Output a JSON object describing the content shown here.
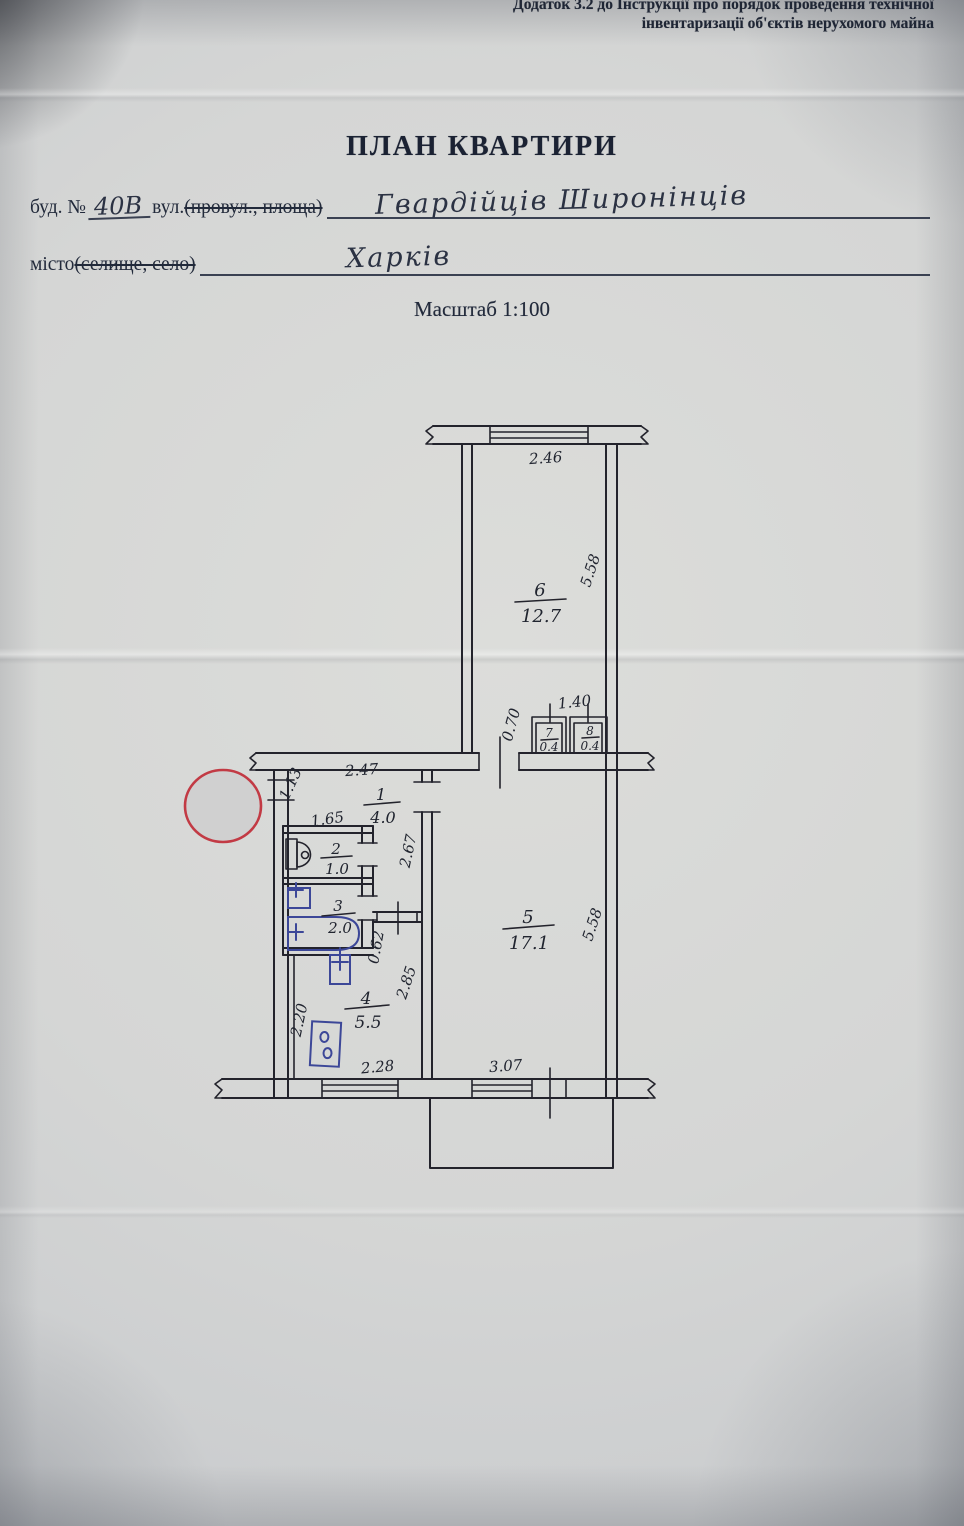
{
  "header": {
    "appendix_line1": "Додаток 3.2 до Інструкції про порядок проведення технічної",
    "appendix_line2": "інвентаризації об'єктів нерухомого майна",
    "title": "ПЛАН КВАРТИРИ",
    "scale": "Масштаб 1:100"
  },
  "form": {
    "building_label": "буд. №",
    "building_number": "40В",
    "street_label": "вул.",
    "street_label_struck": "(провул., площа)",
    "street_value": "Гвардійців Широнінців",
    "city_label": "місто ",
    "city_label_struck": "(селище, село)",
    "city_value": "Харків"
  },
  "plan": {
    "rooms": [
      {
        "number": "1",
        "area": "4.0"
      },
      {
        "number": "2",
        "area": "1.0"
      },
      {
        "number": "3",
        "area": "2.0"
      },
      {
        "number": "4",
        "area": "5.5"
      },
      {
        "number": "5",
        "area": "17.1"
      },
      {
        "number": "6",
        "area": "12.7"
      },
      {
        "number": "7",
        "area": "0.4"
      },
      {
        "number": "8",
        "area": "0.4"
      }
    ],
    "dimensions": {
      "top_window": "2.46",
      "room6_depth": "5.58",
      "closets_width": "1.40",
      "closets_depth": "0.70",
      "hall_width": "2.47",
      "hall_left": "1.13",
      "wc_width": "1.65",
      "hall_length": "2.67",
      "kitchen_door": "0.62",
      "kitchen_wall": "2.85",
      "kitchen_left": "2.20",
      "kitchen_window": "2.28",
      "room5_window": "3.07",
      "room5_depth": "5.58"
    },
    "colors": {
      "plan_ink": "#23232c",
      "fixture_blue": "#3c4798",
      "stamp_red": "#c23a44"
    },
    "fixtures": [
      "toilet-icon",
      "sink-icon",
      "bathtub-icon",
      "kitchen-sink-icon",
      "stove-icon"
    ],
    "stamp": "round-stamp-blank"
  }
}
